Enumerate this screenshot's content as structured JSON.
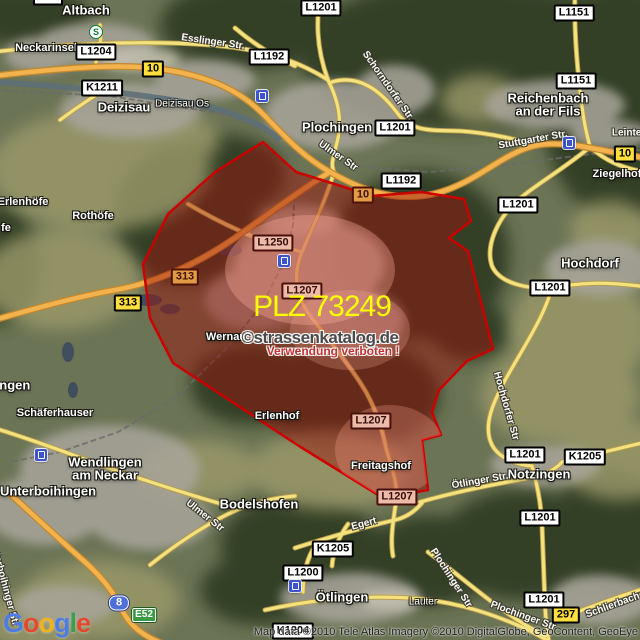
{
  "map": {
    "plz_label": "PLZ 73249",
    "watermark_line1": "©strassenkatalog.de",
    "watermark_line2": "Verwendung verboten !",
    "attribution": "Map data ©2010 Tele Atlas Imagery ©2010 DigitalGlobe, GeoContent, GeoEye",
    "logo_letters": [
      {
        "ch": "G",
        "color": "#4b7bec"
      },
      {
        "ch": "o",
        "color": "#e8452c"
      },
      {
        "ch": "o",
        "color": "#f5b617"
      },
      {
        "ch": "g",
        "color": "#4b7bec"
      },
      {
        "ch": "l",
        "color": "#34a04a"
      },
      {
        "ch": "e",
        "color": "#e8452c"
      }
    ],
    "colors": {
      "region_fill": "rgba(158,16,10,0.47)",
      "region_stroke": "#cc0000",
      "plz_text": "#ffff00",
      "watermark_text": "#4a4a4a",
      "warning_text": "#c23030",
      "federal_road_shield": "#ffdf3d",
      "motorway_shield": "#4f6fd8",
      "euro_route_shield": "#3c9a46"
    },
    "region_points": [
      [
        263,
        142
      ],
      [
        296,
        172
      ],
      [
        341,
        186
      ],
      [
        371,
        196
      ],
      [
        421,
        192
      ],
      [
        464,
        199
      ],
      [
        471,
        221
      ],
      [
        449,
        238
      ],
      [
        468,
        251
      ],
      [
        493,
        349
      ],
      [
        467,
        361
      ],
      [
        439,
        390
      ],
      [
        432,
        412
      ],
      [
        441,
        435
      ],
      [
        422,
        440
      ],
      [
        428,
        490
      ],
      [
        383,
        498
      ],
      [
        299,
        446
      ],
      [
        173,
        363
      ],
      [
        150,
        318
      ],
      [
        143,
        264
      ],
      [
        168,
        214
      ],
      [
        215,
        172
      ]
    ],
    "towns": [
      {
        "text": "Altbach",
        "x": 86,
        "y": 10,
        "size": "lg"
      },
      {
        "text": "Neckarinsel",
        "x": 46,
        "y": 48,
        "size": "md"
      },
      {
        "text": "Deizisau",
        "x": 124,
        "y": 107,
        "size": "lg"
      },
      {
        "text": "Deizisau Os",
        "x": 182,
        "y": 104,
        "size": "sm"
      },
      {
        "text": "Plochingen",
        "x": 337,
        "y": 127,
        "size": "lg"
      },
      {
        "text": "Reichenbach",
        "x": 548,
        "y": 98,
        "size": "lg"
      },
      {
        "text": "an der Fils",
        "x": 548,
        "y": 111,
        "size": "lg"
      },
      {
        "text": "Ziegelhof",
        "x": 617,
        "y": 174,
        "size": "md"
      },
      {
        "text": "Hochdorf",
        "x": 590,
        "y": 263,
        "size": "lg"
      },
      {
        "text": "Erlenhöfe",
        "x": 23,
        "y": 202,
        "size": "md"
      },
      {
        "text": "fe",
        "x": 6,
        "y": 228,
        "size": "md"
      },
      {
        "text": "Rothöfe",
        "x": 93,
        "y": 216,
        "size": "md"
      },
      {
        "text": "Wernau",
        "x": 226,
        "y": 337,
        "size": "md"
      },
      {
        "text": "Erlenhof",
        "x": 277,
        "y": 416,
        "size": "md"
      },
      {
        "text": "Freitagshof",
        "x": 381,
        "y": 466,
        "size": "md"
      },
      {
        "text": "Bodelshofen",
        "x": 259,
        "y": 504,
        "size": "lg"
      },
      {
        "text": "Wendlingen",
        "x": 105,
        "y": 462,
        "size": "lg"
      },
      {
        "text": "am Neckar",
        "x": 105,
        "y": 475,
        "size": "lg"
      },
      {
        "text": "Unterboihingen",
        "x": 48,
        "y": 491,
        "size": "lg"
      },
      {
        "text": "Schäferhauser",
        "x": 55,
        "y": 413,
        "size": "md"
      },
      {
        "text": "ingen",
        "x": 13,
        "y": 385,
        "size": "lg"
      },
      {
        "text": "Notzingen",
        "x": 539,
        "y": 474,
        "size": "lg"
      },
      {
        "text": "Ötlingen",
        "x": 342,
        "y": 597,
        "size": "lg"
      },
      {
        "text": "Lauter",
        "x": 423,
        "y": 602,
        "size": "sm"
      }
    ],
    "streets": [
      {
        "text": "Esslinger Str.",
        "x": 213,
        "y": 42,
        "rot": 8
      },
      {
        "text": "Schorndorfer Str.",
        "x": 388,
        "y": 86,
        "rot": 55
      },
      {
        "text": "Stuttgarter Str.",
        "x": 533,
        "y": 140,
        "rot": -10
      },
      {
        "text": "Leintel",
        "x": 628,
        "y": 133,
        "rot": 0
      },
      {
        "text": "Ulmer Str",
        "x": 338,
        "y": 156,
        "rot": 35
      },
      {
        "text": "Ulmer Str",
        "x": 205,
        "y": 516,
        "rot": 38
      },
      {
        "text": "Hochdorfer Str",
        "x": 506,
        "y": 406,
        "rot": 74
      },
      {
        "text": "Ötlinger Str.",
        "x": 480,
        "y": 481,
        "rot": -10
      },
      {
        "text": "Plochinger Str",
        "x": 451,
        "y": 578,
        "rot": 57
      },
      {
        "text": "Plochinger Str",
        "x": 523,
        "y": 616,
        "rot": 20
      },
      {
        "text": "Schlierbacher Str",
        "x": 625,
        "y": 601,
        "rot": -20
      },
      {
        "text": "Egert",
        "x": 364,
        "y": 524,
        "rot": -15
      },
      {
        "text": "Unterboihinger Str",
        "x": 4,
        "y": 583,
        "rot": 75
      }
    ],
    "shields": [
      {
        "text": "",
        "x": 48,
        "y": 1,
        "kind": "stub"
      },
      {
        "text": "L1204",
        "x": 96,
        "y": 52,
        "kind": "state"
      },
      {
        "text": "K1211",
        "x": 102,
        "y": 88,
        "kind": "state"
      },
      {
        "text": "L1192",
        "x": 269,
        "y": 57,
        "kind": "state"
      },
      {
        "text": "L1201",
        "x": 321,
        "y": 8,
        "kind": "state"
      },
      {
        "text": "L1201",
        "x": 395,
        "y": 128,
        "kind": "state"
      },
      {
        "text": "L1151",
        "x": 574,
        "y": 13,
        "kind": "state"
      },
      {
        "text": "L1151",
        "x": 576,
        "y": 81,
        "kind": "state"
      },
      {
        "text": "L1192",
        "x": 401,
        "y": 181,
        "kind": "state"
      },
      {
        "text": "L1201",
        "x": 518,
        "y": 205,
        "kind": "state"
      },
      {
        "text": "L1201",
        "x": 550,
        "y": 288,
        "kind": "state"
      },
      {
        "text": "L1250",
        "x": 273,
        "y": 243,
        "kind": "state",
        "tinted": true
      },
      {
        "text": "L1207",
        "x": 302,
        "y": 291,
        "kind": "state",
        "tinted": true
      },
      {
        "text": "L1207",
        "x": 371,
        "y": 421,
        "kind": "state",
        "tinted": true
      },
      {
        "text": "L1207",
        "x": 397,
        "y": 497,
        "kind": "state",
        "tinted": true
      },
      {
        "text": "L1201",
        "x": 525,
        "y": 455,
        "kind": "state"
      },
      {
        "text": "K1205",
        "x": 585,
        "y": 457,
        "kind": "state"
      },
      {
        "text": "L1201",
        "x": 540,
        "y": 518,
        "kind": "state"
      },
      {
        "text": "L1201",
        "x": 544,
        "y": 600,
        "kind": "state"
      },
      {
        "text": "K1205",
        "x": 333,
        "y": 549,
        "kind": "state"
      },
      {
        "text": "L1200",
        "x": 303,
        "y": 573,
        "kind": "state"
      },
      {
        "text": "K1204",
        "x": 293,
        "y": 631,
        "kind": "state"
      },
      {
        "text": "10",
        "x": 153,
        "y": 69,
        "kind": "federal"
      },
      {
        "text": "10",
        "x": 363,
        "y": 195,
        "kind": "federal",
        "tinted": true
      },
      {
        "text": "10",
        "x": 625,
        "y": 154,
        "kind": "federal"
      },
      {
        "text": "313",
        "x": 128,
        "y": 303,
        "kind": "federal"
      },
      {
        "text": "313",
        "x": 185,
        "y": 277,
        "kind": "federal",
        "tinted": true
      },
      {
        "text": "297",
        "x": 566,
        "y": 615,
        "kind": "federal"
      },
      {
        "text": "8",
        "x": 119,
        "y": 603,
        "kind": "motorway"
      },
      {
        "text": "E52",
        "x": 144,
        "y": 615,
        "kind": "euro"
      }
    ],
    "stations": [
      {
        "x": 262,
        "y": 96
      },
      {
        "x": 569,
        "y": 143
      },
      {
        "x": 284,
        "y": 261
      },
      {
        "x": 41,
        "y": 455
      },
      {
        "x": 295,
        "y": 586
      }
    ],
    "sbahn": {
      "x": 96,
      "y": 32,
      "label": "S"
    }
  }
}
